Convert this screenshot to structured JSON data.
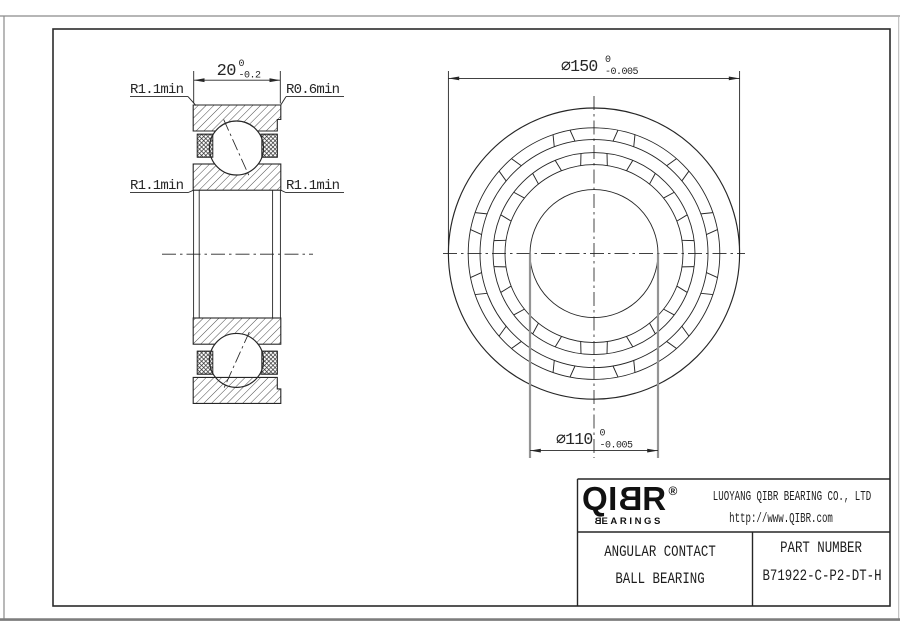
{
  "colors": {
    "line": "#262626",
    "border_inner": "#2b2b2b",
    "sheet_edge": "#8a8a8a",
    "bore_extension": "#949494",
    "background": "#ffffff"
  },
  "section_view": {
    "dim_width": {
      "text": "20",
      "upper": "0",
      "lower": "-0.2"
    },
    "label_top_left": "R1.1min",
    "label_top_right": "R0.6min",
    "label_mid_left": "R1.1min",
    "label_mid_right": "R1.1min"
  },
  "front_view": {
    "dim_outer": {
      "text": "⌀150",
      "upper": "0",
      "lower": "-0.005"
    },
    "dim_bore": {
      "text": "⌀110",
      "upper": "0",
      "lower": "-0.005"
    }
  },
  "title_block": {
    "logo": {
      "qi": "QI",
      "b": "B",
      "r": "R",
      "reg": "®",
      "sub_b": "B",
      "sub_rest": "EARINGS"
    },
    "company": "LUOYANG QIBR BEARING CO., LTD",
    "website": "http://www.QIBR.com",
    "product_line1": "ANGULAR CONTACT",
    "product_line2": "BALL BEARING",
    "part_number_label": "PART NUMBER",
    "part_number": "B71922-C-P2-DT-H"
  }
}
